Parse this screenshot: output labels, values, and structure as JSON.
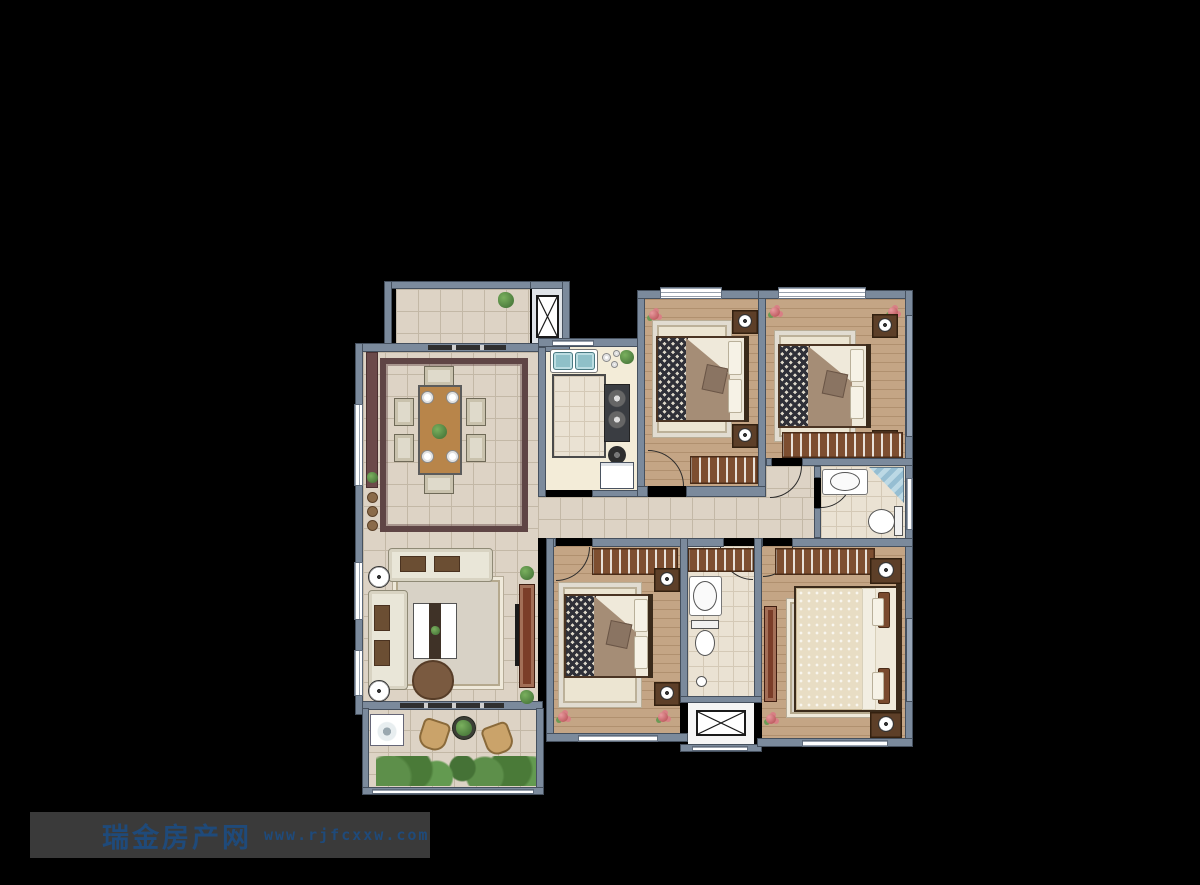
{
  "watermark": {
    "site_name": "瑞金房产网",
    "url": "www.rjfcxxw.com"
  },
  "colors": {
    "background": "#000000",
    "wall": "#7b8a9c",
    "wall_dark": "#45505e",
    "tile_floor": "#ddd3c5",
    "tile_line": "#c3b8a6",
    "wood_floor": "#c4a585",
    "wood_line": "#b0906f",
    "bath_floor": "#eae2d3",
    "counter": "#f3ecd8",
    "rug_cream": "#ece5d2",
    "rug_gray": "#d8d2c6",
    "rug_border_maroon": "#5f4545",
    "wardrobe_brown": "#7d4e30",
    "furniture_dark": "#4a3423",
    "sofa_cream": "#e9e6d8",
    "table_wood": "#b8854a",
    "console_redwood": "#7b3d28",
    "bed_checker_dark": "#2f3038",
    "blanket_taupe": "#a58d76",
    "duvet_cream": "#e8ddc4",
    "shower_blue": "#a9c9d9",
    "sink_teal": "#8fc0c8",
    "plant_green": "#4f7f3f",
    "flower_pink": "#d97f85",
    "watermark_bg": "#3a3a3a",
    "watermark_text": "#1f4a7a"
  },
  "icons": {
    "elevator_icon": "rect with diagonal cross",
    "duct_shaft_icon": "rect with diagonal cross",
    "door_swing_icon": "quarter-circle arc",
    "bed_icon": "bed with checkered duvet and pillows",
    "double_sink_icon": "two teal basins",
    "gas_stove_icon": "dark panel with two burners",
    "fridge_icon": "white box",
    "toilet_icon": "tank and oval bowl",
    "washbasin_icon": "oval basin on counter",
    "shower_icon": "blue tiled corner",
    "washing_machine_icon": "box with drum circle",
    "wardrobe_icon": "rail with hangers",
    "sofa_icon": "cream sofa with cushions",
    "coffee_table_icon": "white table with dark runner",
    "dining_set_icon": "wood table, six chairs, four plates",
    "floor_lamp_icon": "white circle lamp",
    "tv_console_icon": "long redwood cabinet",
    "plant_icon": "green foliage",
    "flower_icon": "pink flower cluster"
  }
}
